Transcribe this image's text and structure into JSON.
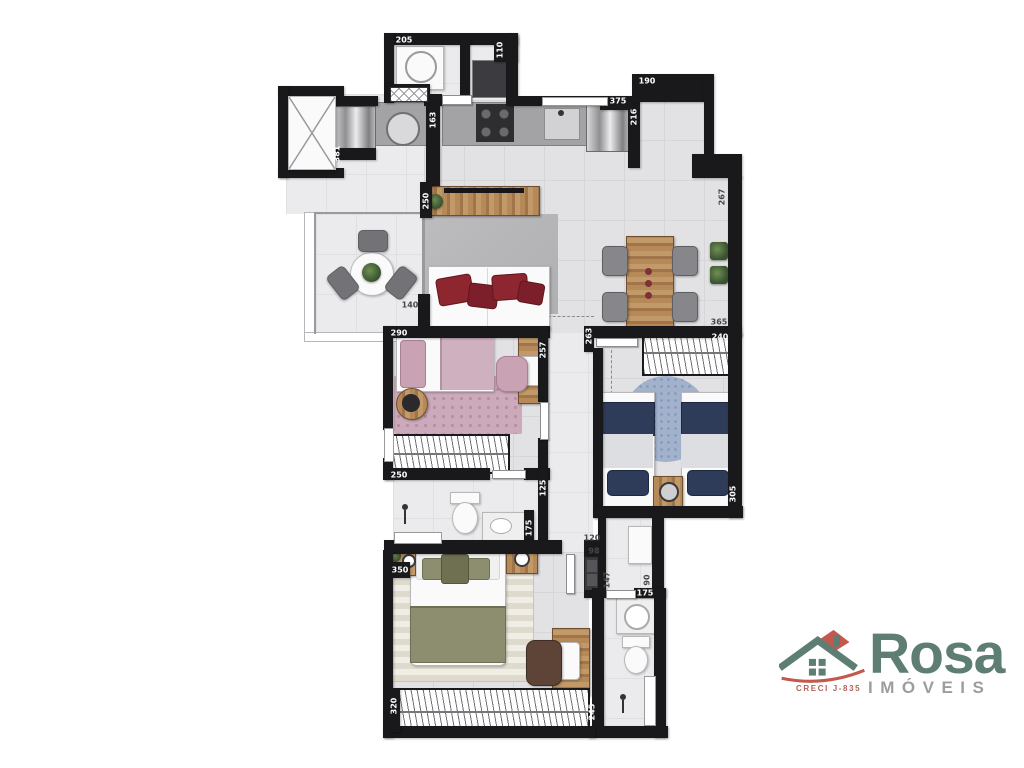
{
  "floorplan": {
    "type": "apartment-floor-plan",
    "wall_color": "#19191b",
    "floor_color": "#e2e2e4",
    "dimension_labels": [
      {
        "text": "205",
        "x": 404,
        "y": 40,
        "rot": 0,
        "dark": false
      },
      {
        "text": "110",
        "x": 500,
        "y": 50,
        "rot": 1,
        "dark": false
      },
      {
        "text": "163",
        "x": 433,
        "y": 120,
        "rot": 1,
        "dark": false
      },
      {
        "text": "381",
        "x": 337,
        "y": 154,
        "rot": 1,
        "dark": false
      },
      {
        "text": "375",
        "x": 618,
        "y": 101,
        "rot": 0,
        "dark": false
      },
      {
        "text": "190",
        "x": 647,
        "y": 81,
        "rot": 0,
        "dark": false
      },
      {
        "text": "216",
        "x": 634,
        "y": 117,
        "rot": 1,
        "dark": false
      },
      {
        "text": "267",
        "x": 722,
        "y": 197,
        "rot": 1,
        "dark": true
      },
      {
        "text": "250",
        "x": 426,
        "y": 201,
        "rot": 1,
        "dark": false
      },
      {
        "text": "140",
        "x": 410,
        "y": 305,
        "rot": 0,
        "dark": true
      },
      {
        "text": "365",
        "x": 719,
        "y": 322,
        "rot": 0,
        "dark": true
      },
      {
        "text": "290",
        "x": 399,
        "y": 333,
        "rot": 0,
        "dark": false
      },
      {
        "text": "257",
        "x": 543,
        "y": 350,
        "rot": 1,
        "dark": false
      },
      {
        "text": "240",
        "x": 720,
        "y": 337,
        "rot": 0,
        "dark": false
      },
      {
        "text": "263",
        "x": 589,
        "y": 336,
        "rot": 1,
        "dark": false
      },
      {
        "text": "250",
        "x": 399,
        "y": 475,
        "rot": 0,
        "dark": false
      },
      {
        "text": "125",
        "x": 543,
        "y": 488,
        "rot": 1,
        "dark": false
      },
      {
        "text": "175",
        "x": 529,
        "y": 528,
        "rot": 1,
        "dark": false
      },
      {
        "text": "120",
        "x": 592,
        "y": 538,
        "rot": 0,
        "dark": true
      },
      {
        "text": "98",
        "x": 594,
        "y": 551,
        "rot": 0,
        "dark": true
      },
      {
        "text": "147",
        "x": 607,
        "y": 580,
        "rot": 1,
        "dark": true
      },
      {
        "text": "90",
        "x": 647,
        "y": 580,
        "rot": 1,
        "dark": true
      },
      {
        "text": "175",
        "x": 645,
        "y": 593,
        "rot": 0,
        "dark": false
      },
      {
        "text": "350",
        "x": 400,
        "y": 570,
        "rot": 0,
        "dark": false
      },
      {
        "text": "320",
        "x": 394,
        "y": 706,
        "rot": 1,
        "dark": false
      },
      {
        "text": "245",
        "x": 592,
        "y": 712,
        "rot": 1,
        "dark": false
      },
      {
        "text": "305",
        "x": 733,
        "y": 494,
        "rot": 1,
        "dark": false
      }
    ]
  },
  "logo": {
    "brand": "Rosa",
    "subtitle": "IMÓVEIS",
    "license": "CRECI J-835",
    "brand_color": "#5e7d73",
    "subtitle_color": "#9d9d9f",
    "license_color": "#b2625a",
    "accent_red": "#c4584e"
  }
}
